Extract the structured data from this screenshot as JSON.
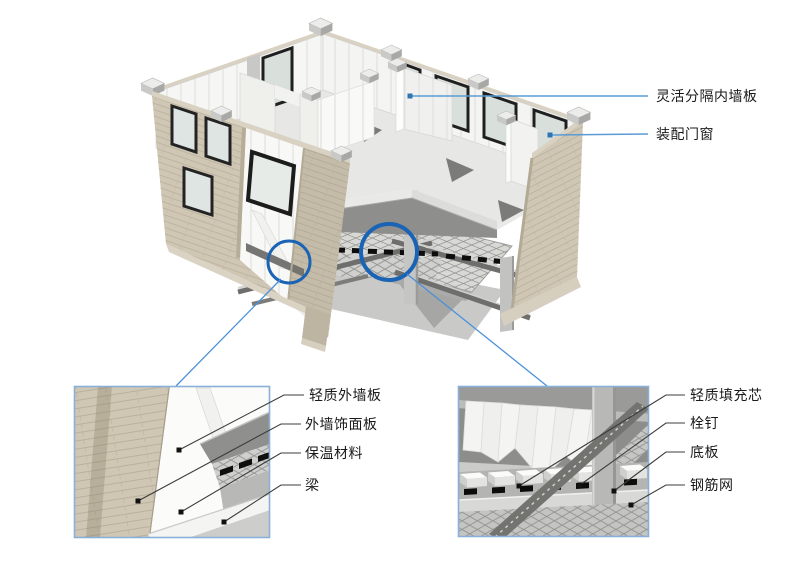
{
  "figure": {
    "title_hint": "prefabricated modular building construction diagram",
    "labels": {
      "main": [
        {
          "text": "灵活分隔内墙板"
        },
        {
          "text": "装配门窗"
        }
      ],
      "detail_left": [
        {
          "text": "轻质外墙板"
        },
        {
          "text": "外墙饰面板"
        },
        {
          "text": "保温材料"
        },
        {
          "text": "梁"
        }
      ],
      "detail_right": [
        {
          "text": "轻质填充芯"
        },
        {
          "text": "栓钉"
        },
        {
          "text": "底板"
        },
        {
          "text": "钢筋网"
        }
      ]
    },
    "colors": {
      "callout_circle_blue": "#1b63b5",
      "connector_blue": "#4a90d9",
      "label_leader_blue": "#5b9bd5",
      "label_leader_dark": "#3c3c3c",
      "brick_beige": "#cfc7b4",
      "panel_white": "#f6f6f4",
      "slab_gray": "#909090",
      "floor_gray": "#e7e7e5",
      "stud_black": "#0d0d0d"
    }
  }
}
